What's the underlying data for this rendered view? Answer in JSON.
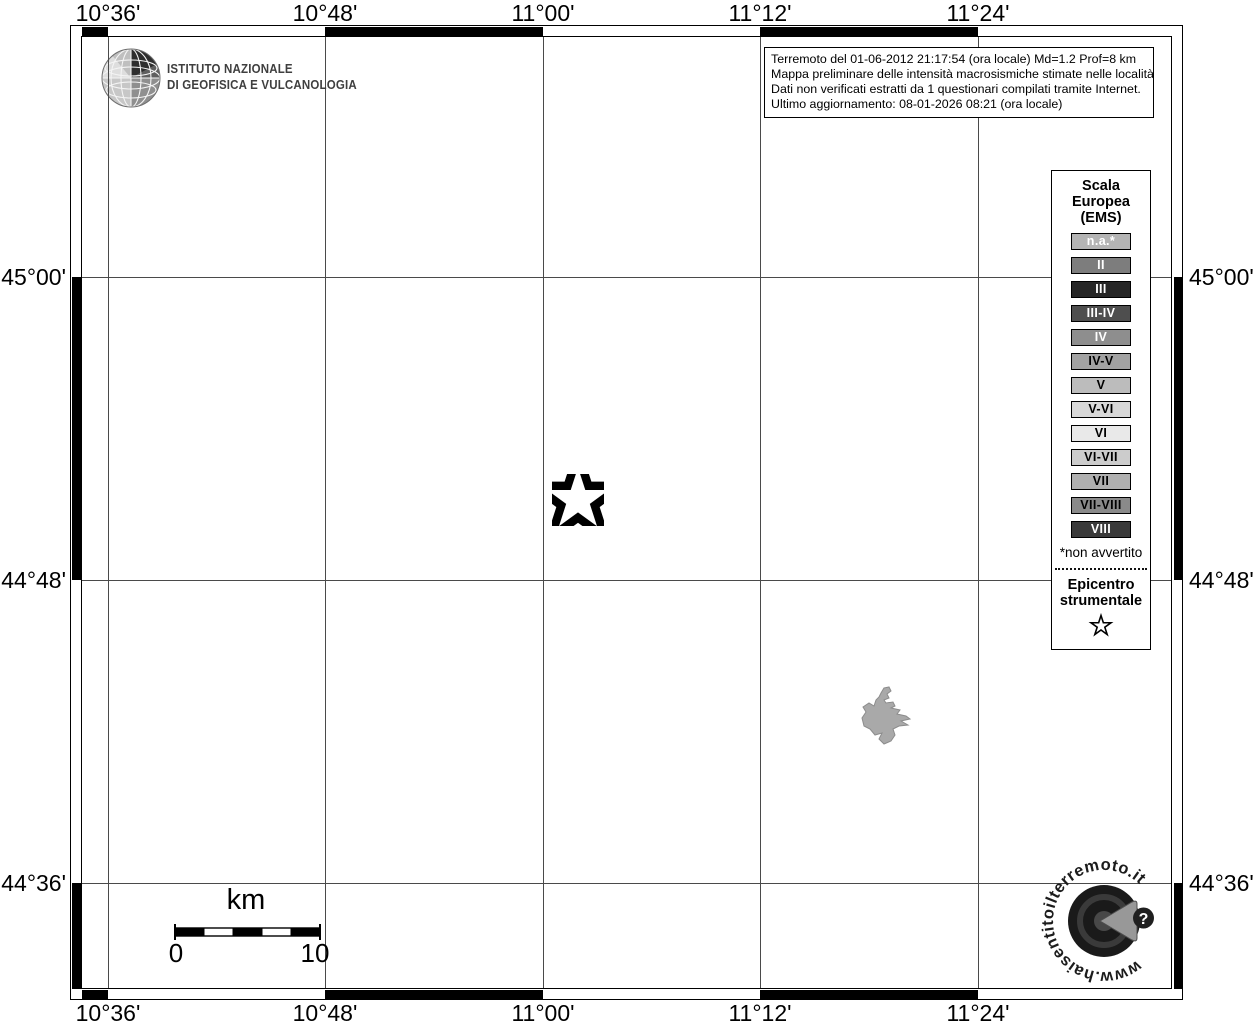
{
  "map": {
    "lon_labels": [
      "10°36'",
      "10°48'",
      "11°00'",
      "11°12'",
      "11°24'"
    ],
    "lat_labels": [
      "45°00'",
      "44°48'",
      "44°36'"
    ],
    "features": {
      "epicenter_symbol": "star",
      "localities": [
        {
          "intensity": "n.a."
        }
      ]
    }
  },
  "branding": {
    "institute_line1": "ISTITUTO NAZIONALE",
    "institute_line2": "DI GEOFISICA E VULCANOLOGIA",
    "watermark_url": "www.haisentitoilterremoto.it",
    "help_glyph": "?"
  },
  "info_box": {
    "line1": "Terremoto del 01-06-2012 21:17:54 (ora locale) Md=1.2 Prof=8 km",
    "line2": "Mappa preliminare delle intensità macrosismiche stimate nelle località",
    "line3": "Dati non verificati estratti da 1 questionari compilati tramite Internet.",
    "line4": "Ultimo aggiornamento: 08-01-2026 08:21 (ora locale)"
  },
  "legend": {
    "title_line1": "Scala",
    "title_line2": "Europea",
    "title_line3": "(EMS)",
    "items": [
      {
        "label": "n.a.*",
        "bg": "#b4b4b4",
        "fg": "#ffffff"
      },
      {
        "label": "II",
        "bg": "#7d7d7d",
        "fg": "#ffffff"
      },
      {
        "label": "III",
        "bg": "#262626",
        "fg": "#ffffff"
      },
      {
        "label": "III-IV",
        "bg": "#4e4e4e",
        "fg": "#ffffff"
      },
      {
        "label": "IV",
        "bg": "#8e8e8e",
        "fg": "#ffffff"
      },
      {
        "label": "IV-V",
        "bg": "#a2a2a2",
        "fg": "#000000"
      },
      {
        "label": "V",
        "bg": "#bcbcbc",
        "fg": "#000000"
      },
      {
        "label": "V-VI",
        "bg": "#d8d8d8",
        "fg": "#000000"
      },
      {
        "label": "VI",
        "bg": "#e9e9e9",
        "fg": "#000000"
      },
      {
        "label": "VI-VII",
        "bg": "#cccccc",
        "fg": "#000000"
      },
      {
        "label": "VII",
        "bg": "#b0b0b0",
        "fg": "#000000"
      },
      {
        "label": "VII-VIII",
        "bg": "#8a8a8a",
        "fg": "#000000"
      },
      {
        "label": "VIII",
        "bg": "#3a3a3a",
        "fg": "#ffffff"
      }
    ],
    "footnote": "*non avvertito",
    "epicenter_line1": "Epicentro",
    "epicenter_line2": "strumentale"
  },
  "scale_bar": {
    "unit_label": "km",
    "min_label": "0",
    "max_label": "10"
  },
  "colors": {
    "grid_line": "#4a4a4a",
    "na_polygon_fill": "#a9a9a9",
    "na_polygon_stroke": "#8c8c8c"
  }
}
